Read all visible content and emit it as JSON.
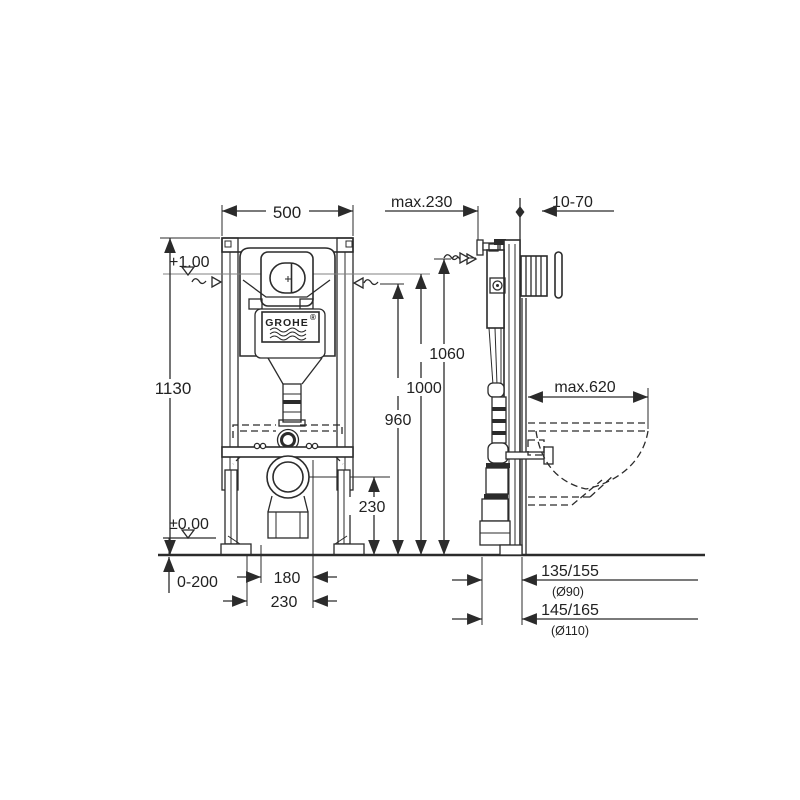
{
  "brand": {
    "logo": "GROHE",
    "registered": "®"
  },
  "front_view": {
    "width": "500",
    "total_height": "1130",
    "upper_level": "+1.00",
    "zero_level": "±0.00",
    "foot_adjustment": "0-200",
    "fixing_spacing_inner": "180",
    "fixing_spacing_outer": "230",
    "outlet_height": "230"
  },
  "side_view": {
    "frame_depth": "max.230",
    "finish_thickness": "10-70",
    "level_960": "960",
    "level_1000": "1000",
    "level_1060": "1060",
    "bowl_projection": "max.620",
    "outlet_dim_90": "135/155",
    "outlet_dia_90": "(Ø90)",
    "outlet_dim_110": "145/165",
    "outlet_dia_110": "(Ø110)"
  },
  "colors": {
    "ink": "#2b2b2b",
    "background": "#ffffff"
  }
}
